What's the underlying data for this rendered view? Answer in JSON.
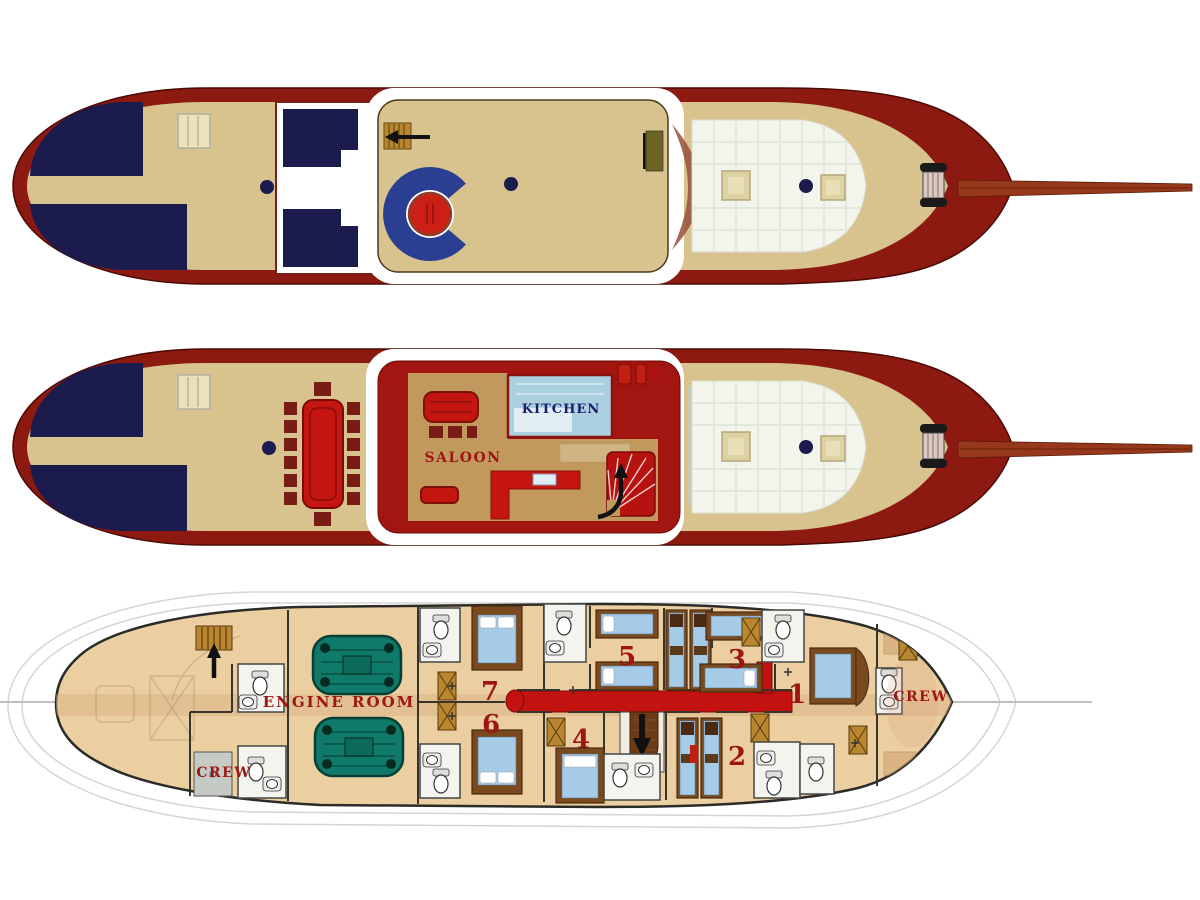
{
  "colors": {
    "hull_red": "#8c1a10",
    "deck_tan": "#d8c28e",
    "navy": "#1b1b4e",
    "cushion_white": "#f3f5ec",
    "saloon_red": "#a31511",
    "bright_red": "#c41511",
    "saloon_floor": "#c2995c",
    "kitchen_blue": "#aad0e0",
    "lower_floor": "#eccfa1",
    "engine_teal": "#107a6a",
    "corridor_red": "#c21310",
    "bed_blue": "#a6cbe6",
    "bed_frame": "#7a4a1e",
    "wood_brown": "#b8872f",
    "bowsprit_brown": "#95381c",
    "label_red": "#9e1515",
    "label_navy": "#1b1b6e"
  },
  "decks": {
    "main_deck": {
      "saloon_label": "SALOON",
      "kitchen_label": "KITCHEN"
    },
    "lower_deck": {
      "engine_room_label": "ENGINE ROOM",
      "crew_aft_label": "CREW",
      "crew_fore_label": "CREW",
      "cabins": [
        {
          "number": "1"
        },
        {
          "number": "2"
        },
        {
          "number": "3"
        },
        {
          "number": "4"
        },
        {
          "number": "5"
        },
        {
          "number": "6"
        },
        {
          "number": "7"
        }
      ]
    }
  }
}
